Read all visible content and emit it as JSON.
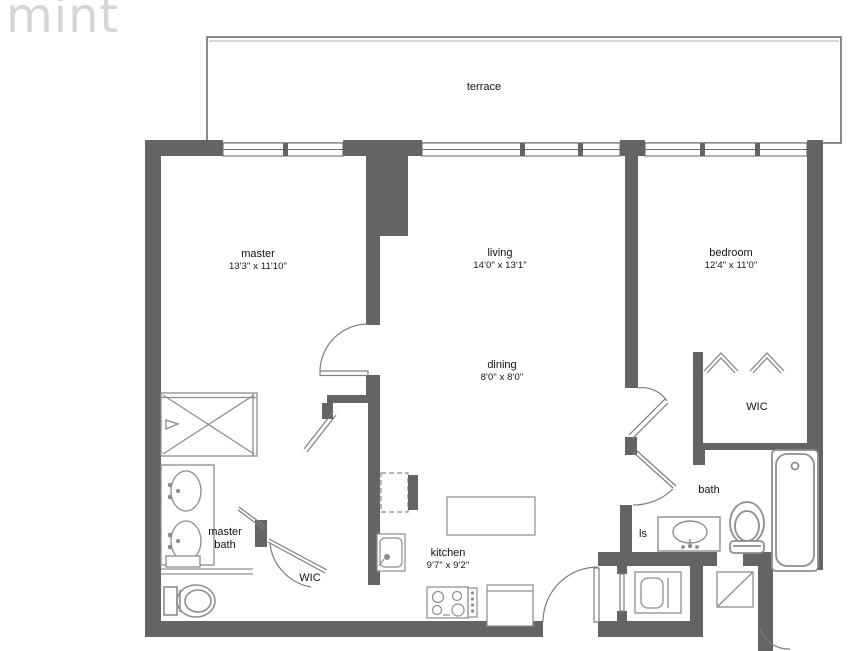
{
  "logo": {
    "text": "mint"
  },
  "colors": {
    "wall": "#646464",
    "structure_line": "#6f6f6f",
    "fixture_line": "#8d8d8d",
    "label_text": "#121212",
    "logo_gray": "#d5d5d7"
  },
  "rooms": {
    "terrace": {
      "label": "terrace"
    },
    "master": {
      "label": "master",
      "dims": "13'3\" x 11'10\""
    },
    "living": {
      "label": "living",
      "dims": "14'0\" x 13'1\""
    },
    "bedroom": {
      "label": "bedroom",
      "dims": "12'4\" x 11'0\""
    },
    "dining": {
      "label": "dining",
      "dims": "8'0\" x 8'0\""
    },
    "wic_bedroom": {
      "label": "WIC"
    },
    "master_bath": {
      "label": "master bath"
    },
    "wic_master": {
      "label": "WIC"
    },
    "kitchen": {
      "label": "kitchen",
      "dims": "9'7\" x 9'2\""
    },
    "bath": {
      "label": "bath"
    },
    "linen": {
      "label": "ls"
    }
  },
  "fixtures": {
    "master_bath": [
      "shower",
      "double-vanity-sinks",
      "toilet",
      "shelf"
    ],
    "kitchen": [
      "refrigerator",
      "kitchen-sink",
      "island-counter",
      "cooktop",
      "dishwasher"
    ],
    "bath": [
      "vanity-sink",
      "toilet",
      "bathtub"
    ],
    "utility": [
      "washer-dryer",
      "ac-unit"
    ],
    "doors": [
      "swing-doors",
      "closet-bifold-doors",
      "entry-door"
    ],
    "windows": [
      "window-band-with-mullions"
    ]
  }
}
